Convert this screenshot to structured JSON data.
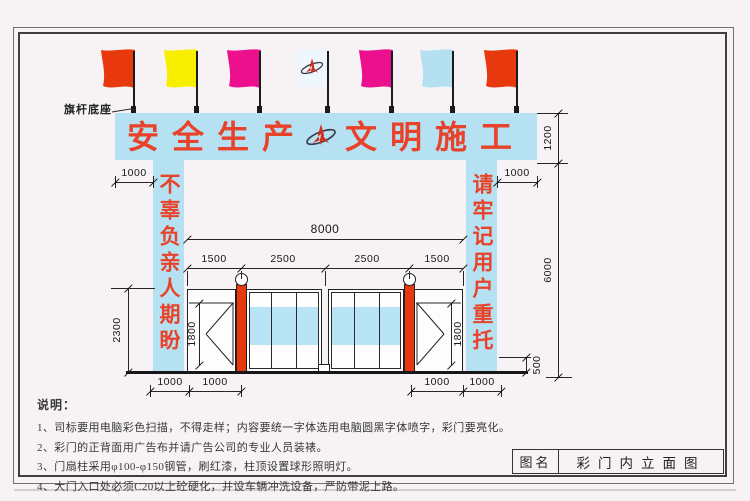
{
  "banner": {
    "left": "安全生产",
    "right": "文明施工"
  },
  "pillars": {
    "left": "不辜负亲人期盼",
    "right": "请牢记用户重托"
  },
  "flag_base_label": "旗杆底座",
  "flags": [
    {
      "name": "red-flag",
      "color": "#e8380d"
    },
    {
      "name": "yellow-flag",
      "color": "#f8ee00"
    },
    {
      "name": "magenta-flag",
      "color": "#ec0f8e"
    },
    {
      "name": "logo-flag",
      "color": "#eef7fc"
    },
    {
      "name": "magenta-flag",
      "color": "#ec0f8e"
    },
    {
      "name": "light-blue-flag",
      "color": "#b5e0f2"
    },
    {
      "name": "red-flag",
      "color": "#e8380d"
    }
  ],
  "dims": {
    "banner_overhang_left": "1000",
    "banner_overhang_right": "1000",
    "gate_total_width": "8000",
    "seg_1": "1500",
    "seg_2": "2500",
    "seg_3": "2500",
    "seg_4": "1500",
    "gate_height": "2300",
    "door_height_left": "1800",
    "door_height_right": "1800",
    "banner_height": "1200",
    "overall_height": "6000",
    "curb_height": "500",
    "bottom_left_outer": "1000",
    "bottom_left_inner": "1000",
    "bottom_right_inner": "1000",
    "bottom_right_outer": "1000"
  },
  "notes": {
    "heading": "说明：",
    "items": [
      "1、司标要用电脑彩色扫描，不得走样；内容要统一字体选用电脑圆黑字体喷字，彩门要亮化。",
      "2、彩门的正背面用广告布并请广告公司的专业人员装裱。",
      "3、门扇柱采用φ100-φ150钢管，刷红漆，柱顶设置球形照明灯。",
      "4、大门入口处必须C20以上砼硬化，并设车辆冲洗设备，严防带泥上路。"
    ]
  },
  "title_block": {
    "label": "图名",
    "title": "彩门内立面图"
  },
  "colors": {
    "banner_blue": "#b5e1f2",
    "gate_band_blue": "#b9e4f5",
    "column_red": "#e8380d",
    "slogan_red": "#e8432a",
    "line_black": "#222222"
  }
}
